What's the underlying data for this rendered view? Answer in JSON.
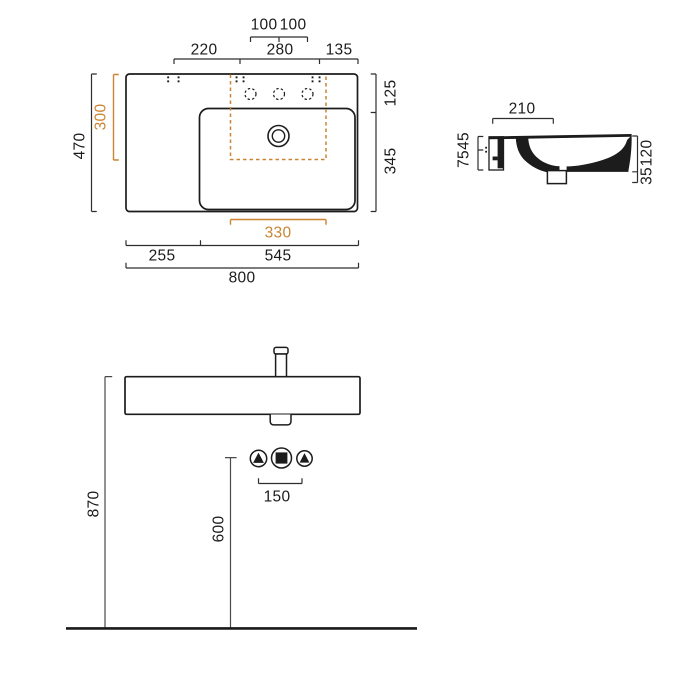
{
  "drawing": {
    "kind": "washbasin technical dimension drawing",
    "views": [
      "plan view",
      "side section",
      "front elevation"
    ]
  },
  "colors": {
    "accent": "#CB8434",
    "object_line": "#1c1c1c",
    "dimension_line": "#2e2e2e"
  },
  "plan": {
    "hole_pitch_left": "100",
    "hole_pitch_right": "100",
    "fix_span_1": "220",
    "fix_span_2": "280",
    "fix_span_3": "135",
    "overall_depth": "470",
    "cutout_depth": "300",
    "rear_ledge_depth": "125",
    "bowl_depth": "345",
    "cutout_width": "330",
    "left_ledge_width": "255",
    "bowl_width": "545",
    "overall_width": "800"
  },
  "side": {
    "ledge_depth": "210",
    "rim_to_fix": "45",
    "fix_to_bottom": "75",
    "body_height": "120",
    "outlet_drop": "35"
  },
  "front": {
    "rim_height": "870",
    "outlet_height": "600",
    "connection_pitch": "150"
  }
}
